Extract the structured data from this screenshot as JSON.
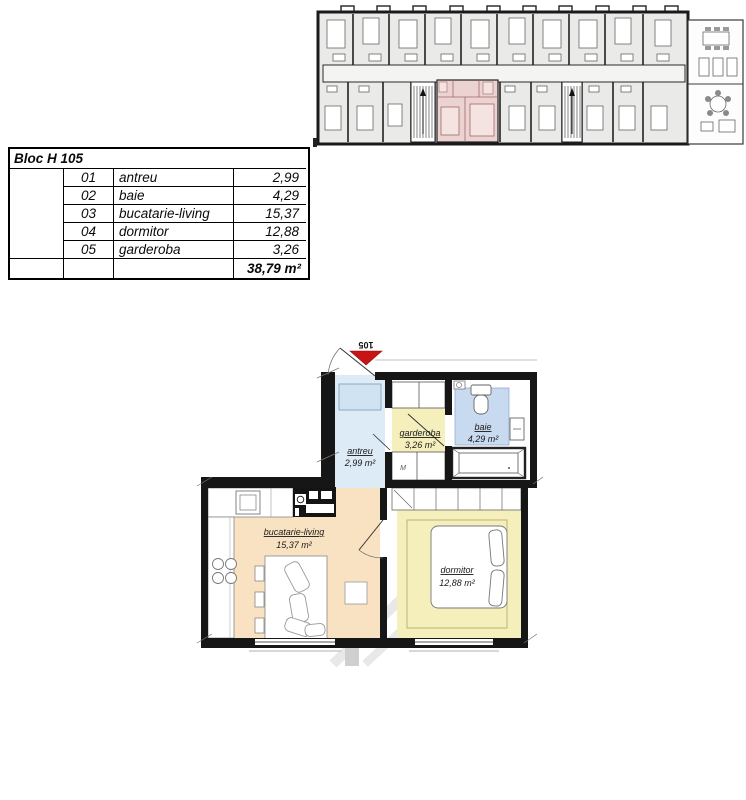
{
  "table": {
    "header": "Bloc H 105",
    "rows": [
      {
        "no": "01",
        "name": "antreu",
        "area": "2,99"
      },
      {
        "no": "02",
        "name": "baie",
        "area": "4,29"
      },
      {
        "no": "03",
        "name": "bucatarie-living",
        "area": "15,37"
      },
      {
        "no": "04",
        "name": "dormitor",
        "area": "12,88"
      },
      {
        "no": "05",
        "name": "garderoba",
        "area": "3,26"
      }
    ],
    "total_area": "38,79 m²"
  },
  "floorplan": {
    "unit_number": "105",
    "rooms": {
      "antreu": {
        "label": "antreu",
        "area": "2,99 m²"
      },
      "garderoba": {
        "label": "garderoba",
        "area": "3,26 m²"
      },
      "baie": {
        "label": "baie",
        "area": "4,29 m²"
      },
      "bucatarie_living": {
        "label": "bucatarie-living",
        "area": "15,37 m²"
      },
      "dormitor": {
        "label": "dormitor",
        "area": "12,88 m²"
      }
    },
    "washing_machine_label": "M"
  },
  "colors": {
    "wall": "#161616",
    "overview_room_fill": "#eaeae8",
    "highlight_unit_fill": "#ecd2d0",
    "highlight_line": "#9b6b6b",
    "antreu_fill": "#dcebf5",
    "baie_mat_fill": "#c8daef",
    "yellow_room_fill": "#f5efbc",
    "kitchen_living_fill": "#f9e2c1",
    "marker_red": "#c81414",
    "total_blue": "#1d3ca8"
  }
}
